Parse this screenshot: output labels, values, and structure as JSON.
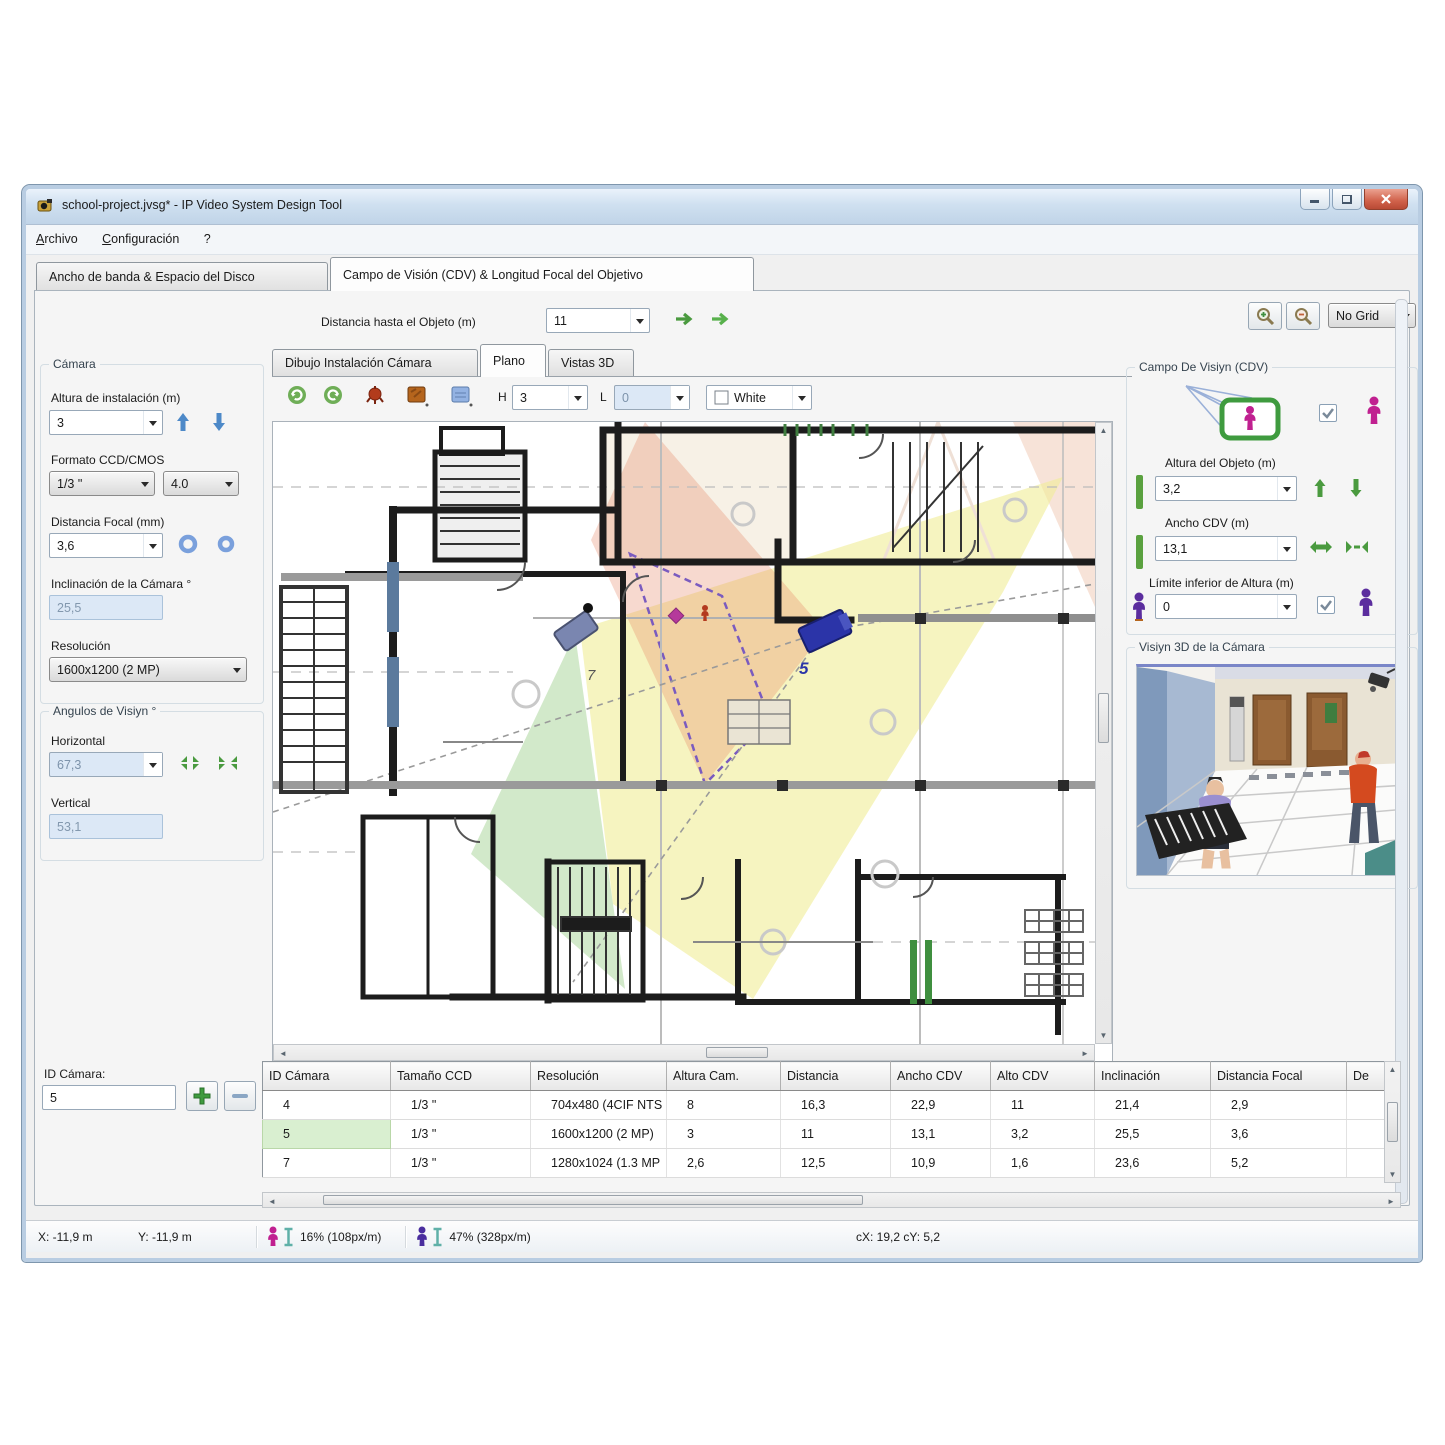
{
  "window": {
    "title": "school-project.jvsg* - IP Video System Design Tool"
  },
  "menu": [
    "Archivo",
    "Configuración",
    "?"
  ],
  "main_tabs": [
    "Ancho de banda & Espacio del Disco",
    "Campo de Visión (CDV) & Longitud Focal del Objetivo"
  ],
  "top_controls": {
    "distance_label": "Distancia hasta el Objeto (m)",
    "distance_value": "11",
    "grid_value": "No Grid"
  },
  "plan_tabs": [
    "Dibujo Instalación Cámara",
    "Plano",
    "Vistas 3D"
  ],
  "plan_toolbar": {
    "h_label": "H",
    "h_value": "3",
    "l_label": "L",
    "l_value": "0",
    "color_value": "White"
  },
  "camera_panel": {
    "title": "Cámara",
    "install_height_label": "Altura de instalación (m)",
    "install_height_value": "3",
    "format_label": "Formato CCD/CMOS",
    "format_value": "1/3 \"",
    "format_ratio_value": "4.0",
    "focal_label": "Distancia Focal (mm)",
    "focal_value": "3,6",
    "tilt_label": "Inclinación de la Cámara °",
    "tilt_value": "25,5",
    "resolution_label": "Resolución",
    "resolution_value": "1600x1200 (2 MP)"
  },
  "angles_panel": {
    "title": "Angulos de Visiyn °",
    "horizontal_label": "Horizontal",
    "horizontal_value": "67,3",
    "vertical_label": "Vertical",
    "vertical_value": "53,1"
  },
  "camera_id": {
    "label": "ID Cámara:",
    "value": "5"
  },
  "fov_panel": {
    "title": "Campo De Visiyn (CDV)",
    "object_height_label": "Altura del Objeto (m)",
    "object_height_value": "3,2",
    "fov_width_label": "Ancho CDV (m)",
    "fov_width_value": "13,1",
    "lower_limit_label": "Límite inferior de Altura (m)",
    "lower_limit_value": "0"
  },
  "view3d_panel": {
    "title": "Visiyn 3D de la Cámara"
  },
  "plan": {
    "camera5_label": "5",
    "camera7_label": "7"
  },
  "table": {
    "columns": [
      "ID Cámara",
      "Tamaño CCD",
      "Resolución",
      "Altura Cam.",
      "Distancia",
      "Ancho CDV",
      "Alto CDV",
      "Inclinación",
      "Distancia Focal",
      "De"
    ],
    "rows": [
      {
        "selected": false,
        "cells": [
          "4",
          "1/3 \"",
          "704x480 (4CIF NTS",
          "8",
          "16,3",
          "22,9",
          "11",
          "21,4",
          "2,9",
          ""
        ]
      },
      {
        "selected": true,
        "cells": [
          "5",
          "1/3 \"",
          "1600x1200 (2 MP)",
          "3",
          "11",
          "13,1",
          "3,2",
          "25,5",
          "3,6",
          ""
        ]
      },
      {
        "selected": false,
        "cells": [
          "7",
          "1/3 \"",
          "1280x1024 (1.3 MP",
          "2,6",
          "12,5",
          "10,9",
          "1,6",
          "23,6",
          "5,2",
          ""
        ]
      }
    ]
  },
  "status_bar": {
    "x": "X: -11,9 m",
    "y": "Y: -11,9 m",
    "density1": "16% (108px/m)",
    "density2": "47% (328px/m)",
    "cursor": "cX: 19,2  cY: 5,2"
  },
  "colors": {
    "accent_green": "#4a9a3f",
    "magenta": "#c02090",
    "purple": "#5b2d9e",
    "camera_blue": "#2b34a8",
    "fov_yellow": "#f0ee9a",
    "fov_green": "#bfe0b0",
    "fov_salmon": "#eec0a8"
  }
}
